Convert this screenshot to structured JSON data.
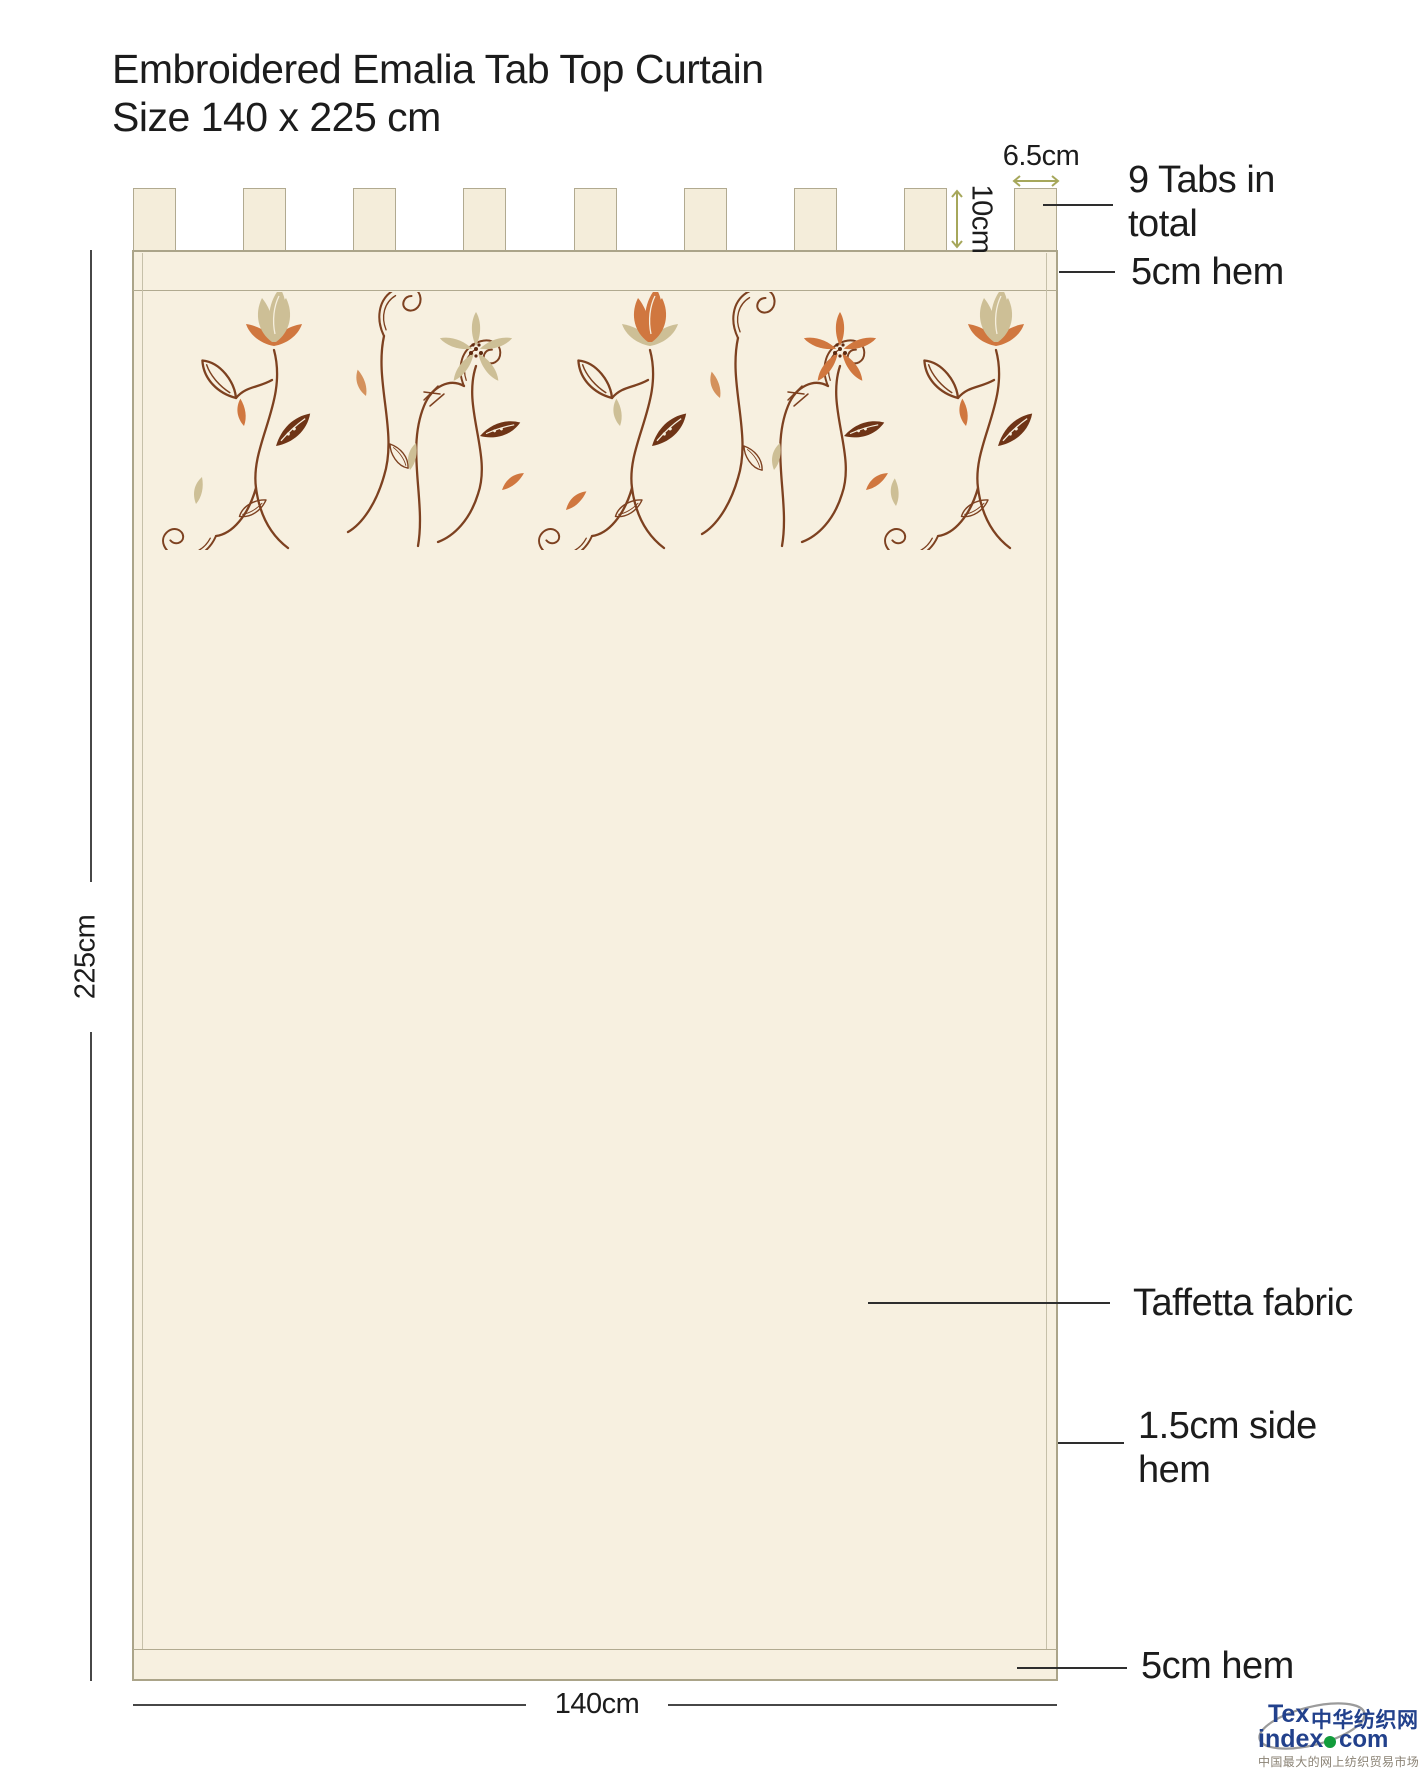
{
  "title": {
    "line1": "Embroidered Emalia Tab Top Curtain",
    "line2": "Size 140 x 225 cm"
  },
  "dimensions": {
    "height_label": "225cm",
    "width_label": "140cm",
    "tab_width_label": "6.5cm",
    "tab_height_label": "10cm"
  },
  "callouts": {
    "tabs_line1": "9 Tabs in",
    "tabs_line2": "total",
    "top_hem": "5cm hem",
    "fabric": "Taffetta fabric",
    "side_hem_line1": "1.5cm side",
    "side_hem_line2": "hem",
    "bottom_hem": "5cm hem"
  },
  "curtain": {
    "tab_count": 9
  },
  "logo": {
    "tex": "Tex",
    "index": "index",
    "dot_com": "com",
    "cn_name": "中华纺织网",
    "tagline": "中国最大的网上纺织贸易市场"
  },
  "colors": {
    "fabric": "#f7f0e0",
    "outline": "#aba489",
    "stem_brown": "#7d4120",
    "flower_tan": "#cdbf96",
    "flower_orange": "#d0773f",
    "arrow_olive": "#a6a75b",
    "dimension_line": "#474747",
    "logo_blue": "#22418c",
    "logo_green": "#129c3c",
    "logo_gray": "#8a8274"
  }
}
